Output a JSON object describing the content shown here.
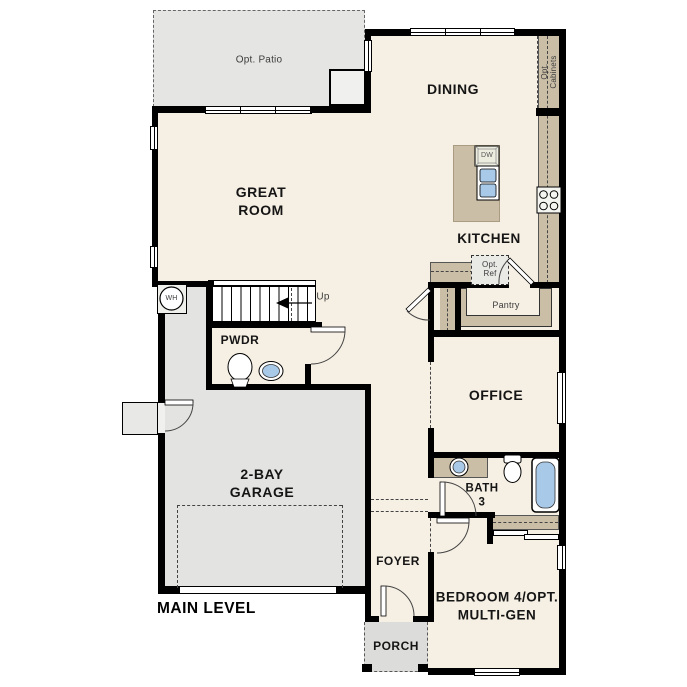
{
  "plan": {
    "title": "MAIN LEVEL",
    "rooms": {
      "opt_patio": "Opt. Patio",
      "great_room": "GREAT\nROOM",
      "dining": "DINING",
      "kitchen": "KITCHEN",
      "opt_cabinets": "Opt.\nCabinets",
      "opt_ref": "Opt.\nRef",
      "pantry": "Pantry",
      "pwdr": "PWDR",
      "office": "OFFICE",
      "bath3": "BATH\n3",
      "garage": "2-BAY\nGARAGE",
      "foyer": "FOYER",
      "bedroom4": "BEDROOM 4/OPT.\nMULTI-GEN",
      "porch": "PORCH"
    },
    "annotations": {
      "stairs_up": "Up",
      "water_heater": "WH",
      "dishwasher": "DW"
    },
    "colors": {
      "wall": "#000000",
      "living_area": "#f6efe3",
      "garage_area": "#e3e3e1",
      "porch_area": "#dcdcda",
      "patio_area": "#e5e5e3",
      "cabinetry": "#cabea6",
      "fixture_blue": "#a9c9e9"
    }
  }
}
